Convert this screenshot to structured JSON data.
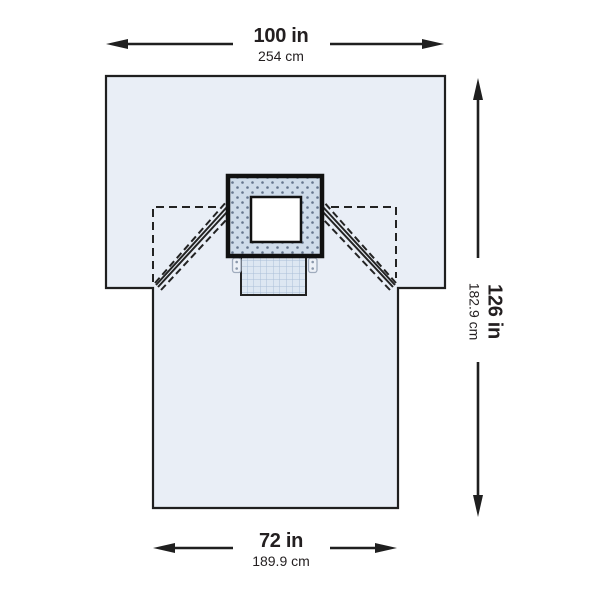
{
  "diagram": {
    "type": "product-dimension-diagram",
    "product": "surgical-drape-with-fenestration-and-pouch",
    "labels": {
      "width_top": {
        "in": "100 in",
        "cm": "254 cm"
      },
      "height_right": {
        "in": "126 in",
        "cm": "182.9 cm"
      },
      "width_bottom": {
        "in": "72 in",
        "cm": "189.9 cm"
      }
    },
    "parts": {
      "drape_body": "t-shaped-drape-outline",
      "reinforcement": "dotted-reinforcement-square",
      "fenestration": "white-fenestration-window",
      "pouch": "gridded-fluid-pouch",
      "tabs": "tube-holder-tabs",
      "flaps": "dashed-fold-lines-with-tape-bands"
    },
    "colors": {
      "canvas_bg": "#ffffff",
      "drape_fill": "#e9eef6",
      "reinforcement_fill": "#cfdcea",
      "reinforcement_dot": "#64748c",
      "pouch_fill": "#dde7f2",
      "pouch_grid": "#aabfd8",
      "outline": "#1f1f1f",
      "text": "#231f20"
    }
  }
}
